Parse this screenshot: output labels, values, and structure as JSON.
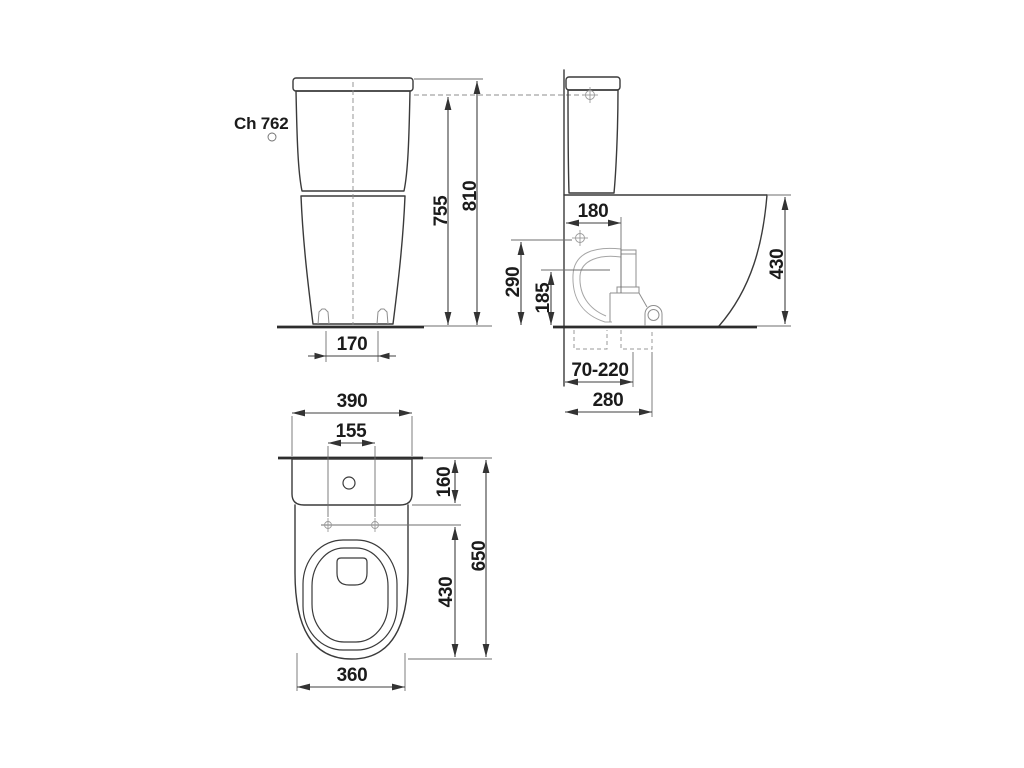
{
  "label": {
    "code": "Ch 762"
  },
  "colors": {
    "line": "#3a3a3a",
    "light_detail": "#a5a5a5",
    "text": "#1b1b1b",
    "background": "#ffffff"
  },
  "front": {
    "height_to_tank_body_top": "755",
    "height_total": "810",
    "foot_fixing_spacing": "170"
  },
  "side": {
    "flush_valve_offset": "180",
    "water_supply_height": "290",
    "outlet_center_height": "185",
    "bowl_height": "430",
    "floor_outlet_range": "70-220",
    "outlet_max_depth": "280"
  },
  "top": {
    "tank_width": "390",
    "seat_hinge_hole_spacing": "155",
    "tank_zone_depth": "160",
    "total_depth": "650",
    "seat_zone_length": "430",
    "bowl_width": "360"
  }
}
